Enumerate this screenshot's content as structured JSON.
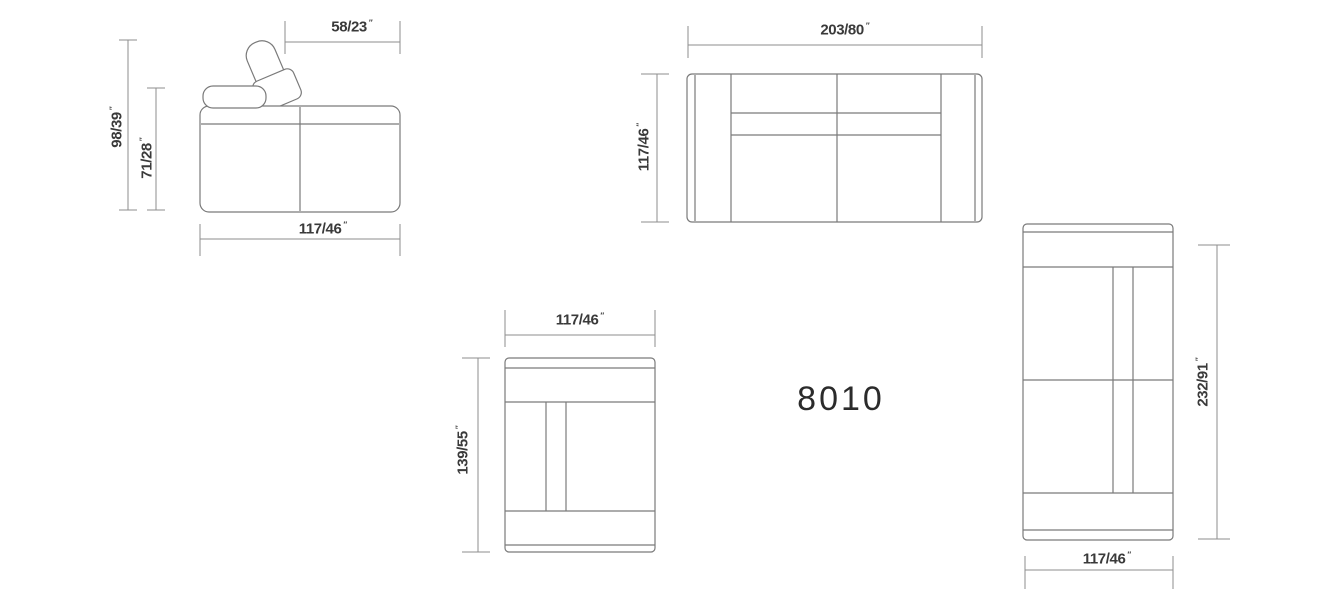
{
  "product_code": "8010",
  "unit_mark": "″",
  "colors": {
    "background": "#ffffff",
    "furniture_line": "#7a7a7a",
    "dimension_line": "#8d8d8d",
    "label_text": "#3a3a3a",
    "title_text": "#2b2b2b"
  },
  "views": {
    "side": {
      "name": "sofa side elevation",
      "labels": {
        "headrest_depth": "58/23",
        "overall_height": "98/39",
        "back_height": "71/28",
        "depth": "117/46"
      }
    },
    "top": {
      "name": "two-seat sofa plan view",
      "labels": {
        "width": "203/80",
        "depth": "117/46"
      }
    },
    "seat": {
      "name": "single seat plan view",
      "labels": {
        "width": "117/46",
        "depth": "139/55"
      }
    },
    "chaise": {
      "name": "chaise plan view",
      "labels": {
        "length": "232/91",
        "width": "117/46"
      }
    }
  }
}
